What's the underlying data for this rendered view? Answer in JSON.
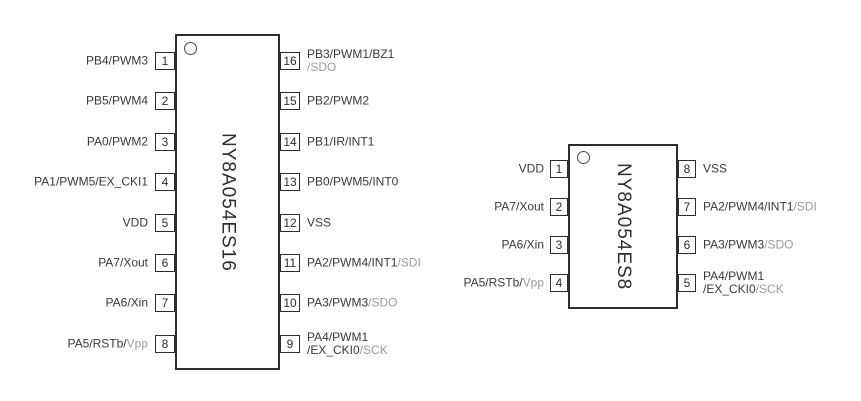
{
  "colors": {
    "line": "#2d2d2d",
    "text": "#3a3a3a",
    "muted_text": "#9b9b9b",
    "background": "#ffffff"
  },
  "chips": [
    {
      "name": "NY8A054ES16",
      "left_pins": [
        {
          "number": "1",
          "lines": [
            [
              {
                "t": "PB4/PWM3"
              }
            ]
          ]
        },
        {
          "number": "2",
          "lines": [
            [
              {
                "t": "PB5/PWM4"
              }
            ]
          ]
        },
        {
          "number": "3",
          "lines": [
            [
              {
                "t": "PA0/PWM2"
              }
            ]
          ]
        },
        {
          "number": "4",
          "lines": [
            [
              {
                "t": "PA1/PWM5/EX_CKI1"
              }
            ]
          ]
        },
        {
          "number": "5",
          "lines": [
            [
              {
                "t": "VDD"
              }
            ]
          ]
        },
        {
          "number": "6",
          "lines": [
            [
              {
                "t": "PA7/Xout"
              }
            ]
          ]
        },
        {
          "number": "7",
          "lines": [
            [
              {
                "t": "PA6/Xin"
              }
            ]
          ]
        },
        {
          "number": "8",
          "lines": [
            [
              {
                "t": "PA5/RSTb/"
              },
              {
                "t": "Vpp",
                "muted": true
              }
            ]
          ]
        }
      ],
      "right_pins": [
        {
          "number": "16",
          "lines": [
            [
              {
                "t": "PB3/PWM1/BZ1"
              }
            ],
            [
              {
                "t": "/SDO",
                "muted": true
              }
            ]
          ]
        },
        {
          "number": "15",
          "lines": [
            [
              {
                "t": "PB2/PWM2"
              }
            ]
          ]
        },
        {
          "number": "14",
          "lines": [
            [
              {
                "t": "PB1/IR/INT1"
              }
            ]
          ]
        },
        {
          "number": "13",
          "lines": [
            [
              {
                "t": "PB0/PWM5/INT0"
              }
            ]
          ]
        },
        {
          "number": "12",
          "lines": [
            [
              {
                "t": "VSS"
              }
            ]
          ]
        },
        {
          "number": "11",
          "lines": [
            [
              {
                "t": "PA2/PWM4/INT1"
              },
              {
                "t": "/SDI",
                "muted": true
              }
            ]
          ]
        },
        {
          "number": "10",
          "lines": [
            [
              {
                "t": "PA3/PWM3"
              },
              {
                "t": "/SDO",
                "muted": true
              }
            ]
          ]
        },
        {
          "number": "9",
          "lines": [
            [
              {
                "t": "PA4/PWM1"
              }
            ],
            [
              {
                "t": "/EX_CKI0"
              },
              {
                "t": "/SCK",
                "muted": true
              }
            ]
          ]
        }
      ]
    },
    {
      "name": "NY8A054ES8",
      "left_pins": [
        {
          "number": "1",
          "lines": [
            [
              {
                "t": "VDD"
              }
            ]
          ]
        },
        {
          "number": "2",
          "lines": [
            [
              {
                "t": "PA7/Xout"
              }
            ]
          ]
        },
        {
          "number": "3",
          "lines": [
            [
              {
                "t": "PA6/Xin"
              }
            ]
          ]
        },
        {
          "number": "4",
          "lines": [
            [
              {
                "t": "PA5/RSTb/"
              },
              {
                "t": "Vpp",
                "muted": true
              }
            ]
          ]
        }
      ],
      "right_pins": [
        {
          "number": "8",
          "lines": [
            [
              {
                "t": "VSS"
              }
            ]
          ]
        },
        {
          "number": "7",
          "lines": [
            [
              {
                "t": "PA2/PWM4/INT1"
              },
              {
                "t": "/SDI",
                "muted": true
              }
            ]
          ]
        },
        {
          "number": "6",
          "lines": [
            [
              {
                "t": "PA3/PWM3"
              },
              {
                "t": "/SDO",
                "muted": true
              }
            ]
          ]
        },
        {
          "number": "5",
          "lines": [
            [
              {
                "t": "PA4/PWM1"
              }
            ],
            [
              {
                "t": "/EX_CKI0"
              },
              {
                "t": "/SCK",
                "muted": true
              }
            ]
          ]
        }
      ]
    }
  ]
}
